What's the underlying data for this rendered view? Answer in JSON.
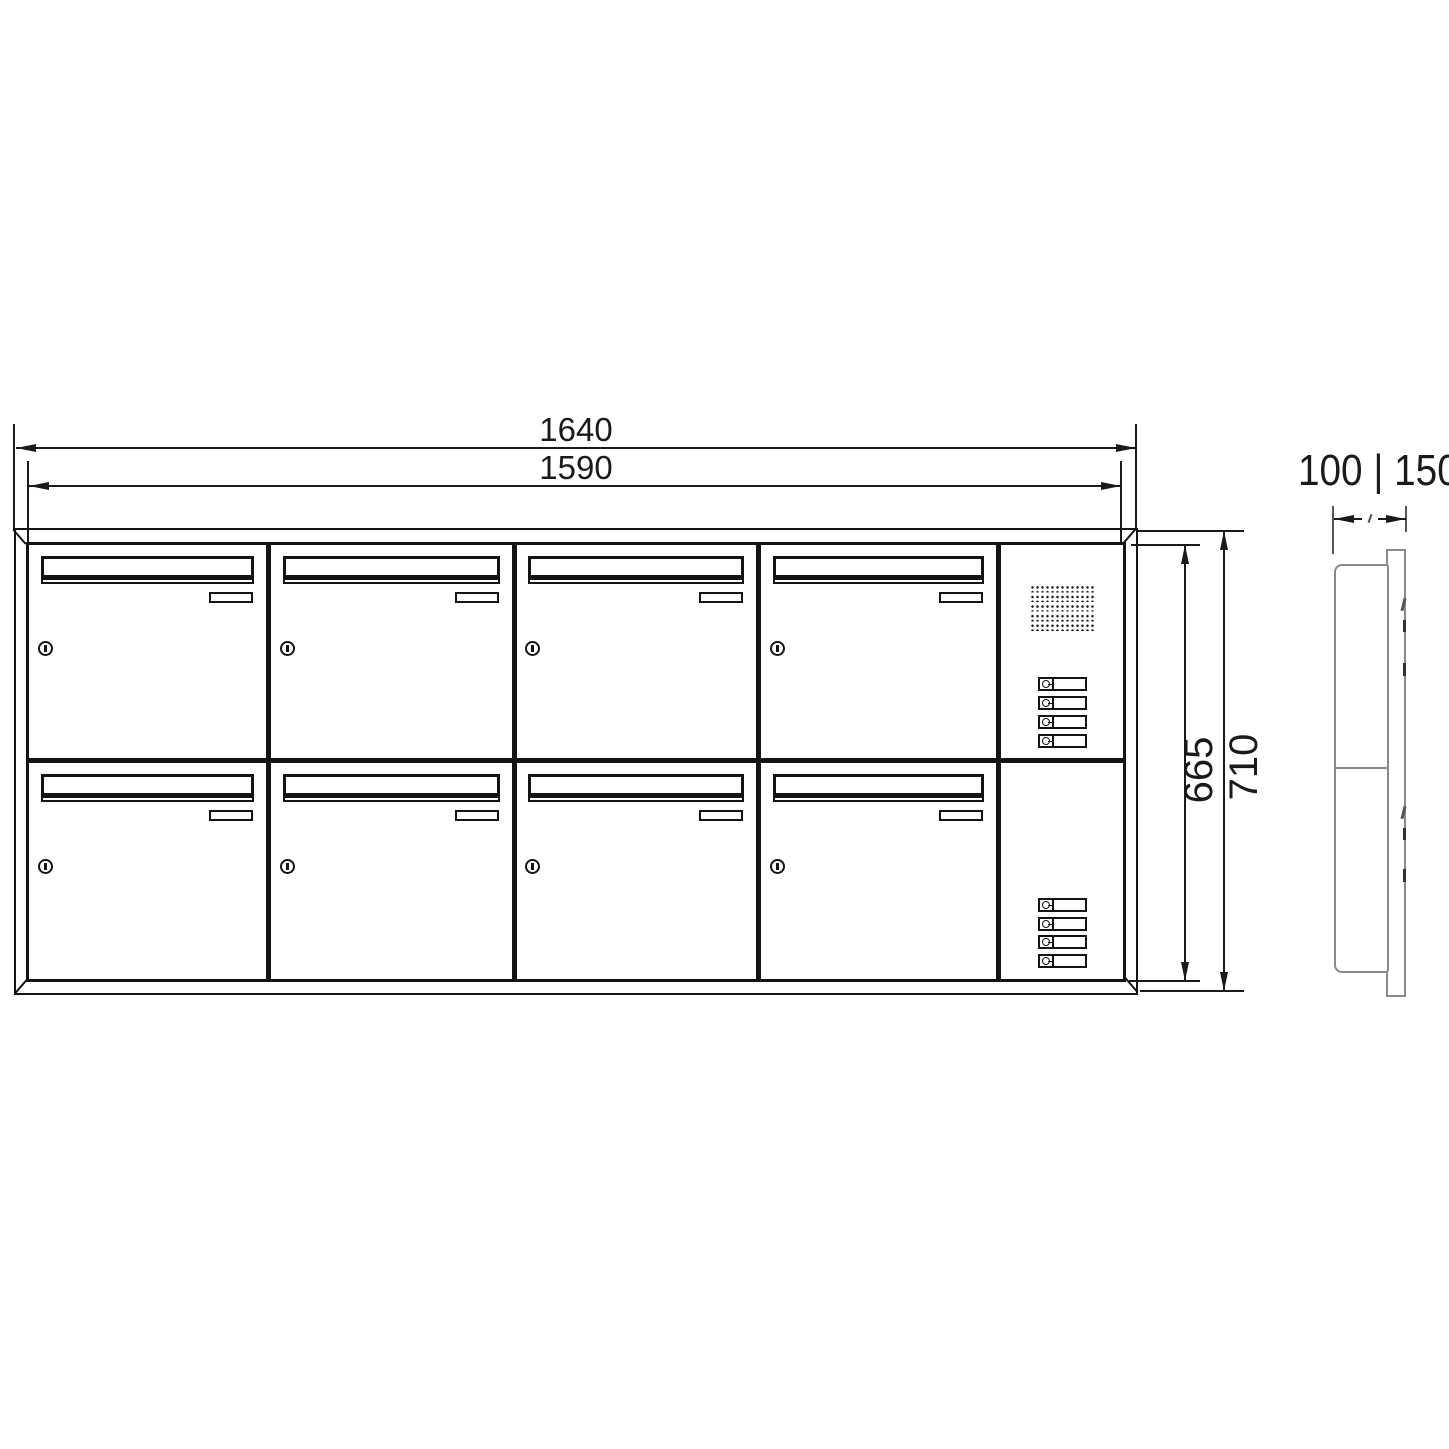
{
  "drawing": {
    "description": "Technical dimension drawing of an 8-door letterbox bank with intercom panel: front view and side view"
  },
  "dimensions": {
    "top_outer_width": "1640",
    "top_inner_width": "1590",
    "right_inner_height": "665",
    "right_outer_height": "710",
    "side_depth_options": "100 | 150"
  },
  "unit": {
    "mailbox_rows": 2,
    "mailbox_columns": 4,
    "mailbox_count": 8,
    "intercom_sections": 2,
    "bell_buttons_per_section": 4,
    "has_speaker_grille": true
  },
  "colors": {
    "front_line": "#141414",
    "dimension_line": "#1a1a1a",
    "side_line": "#8a8a8a",
    "background": "#ffffff"
  }
}
